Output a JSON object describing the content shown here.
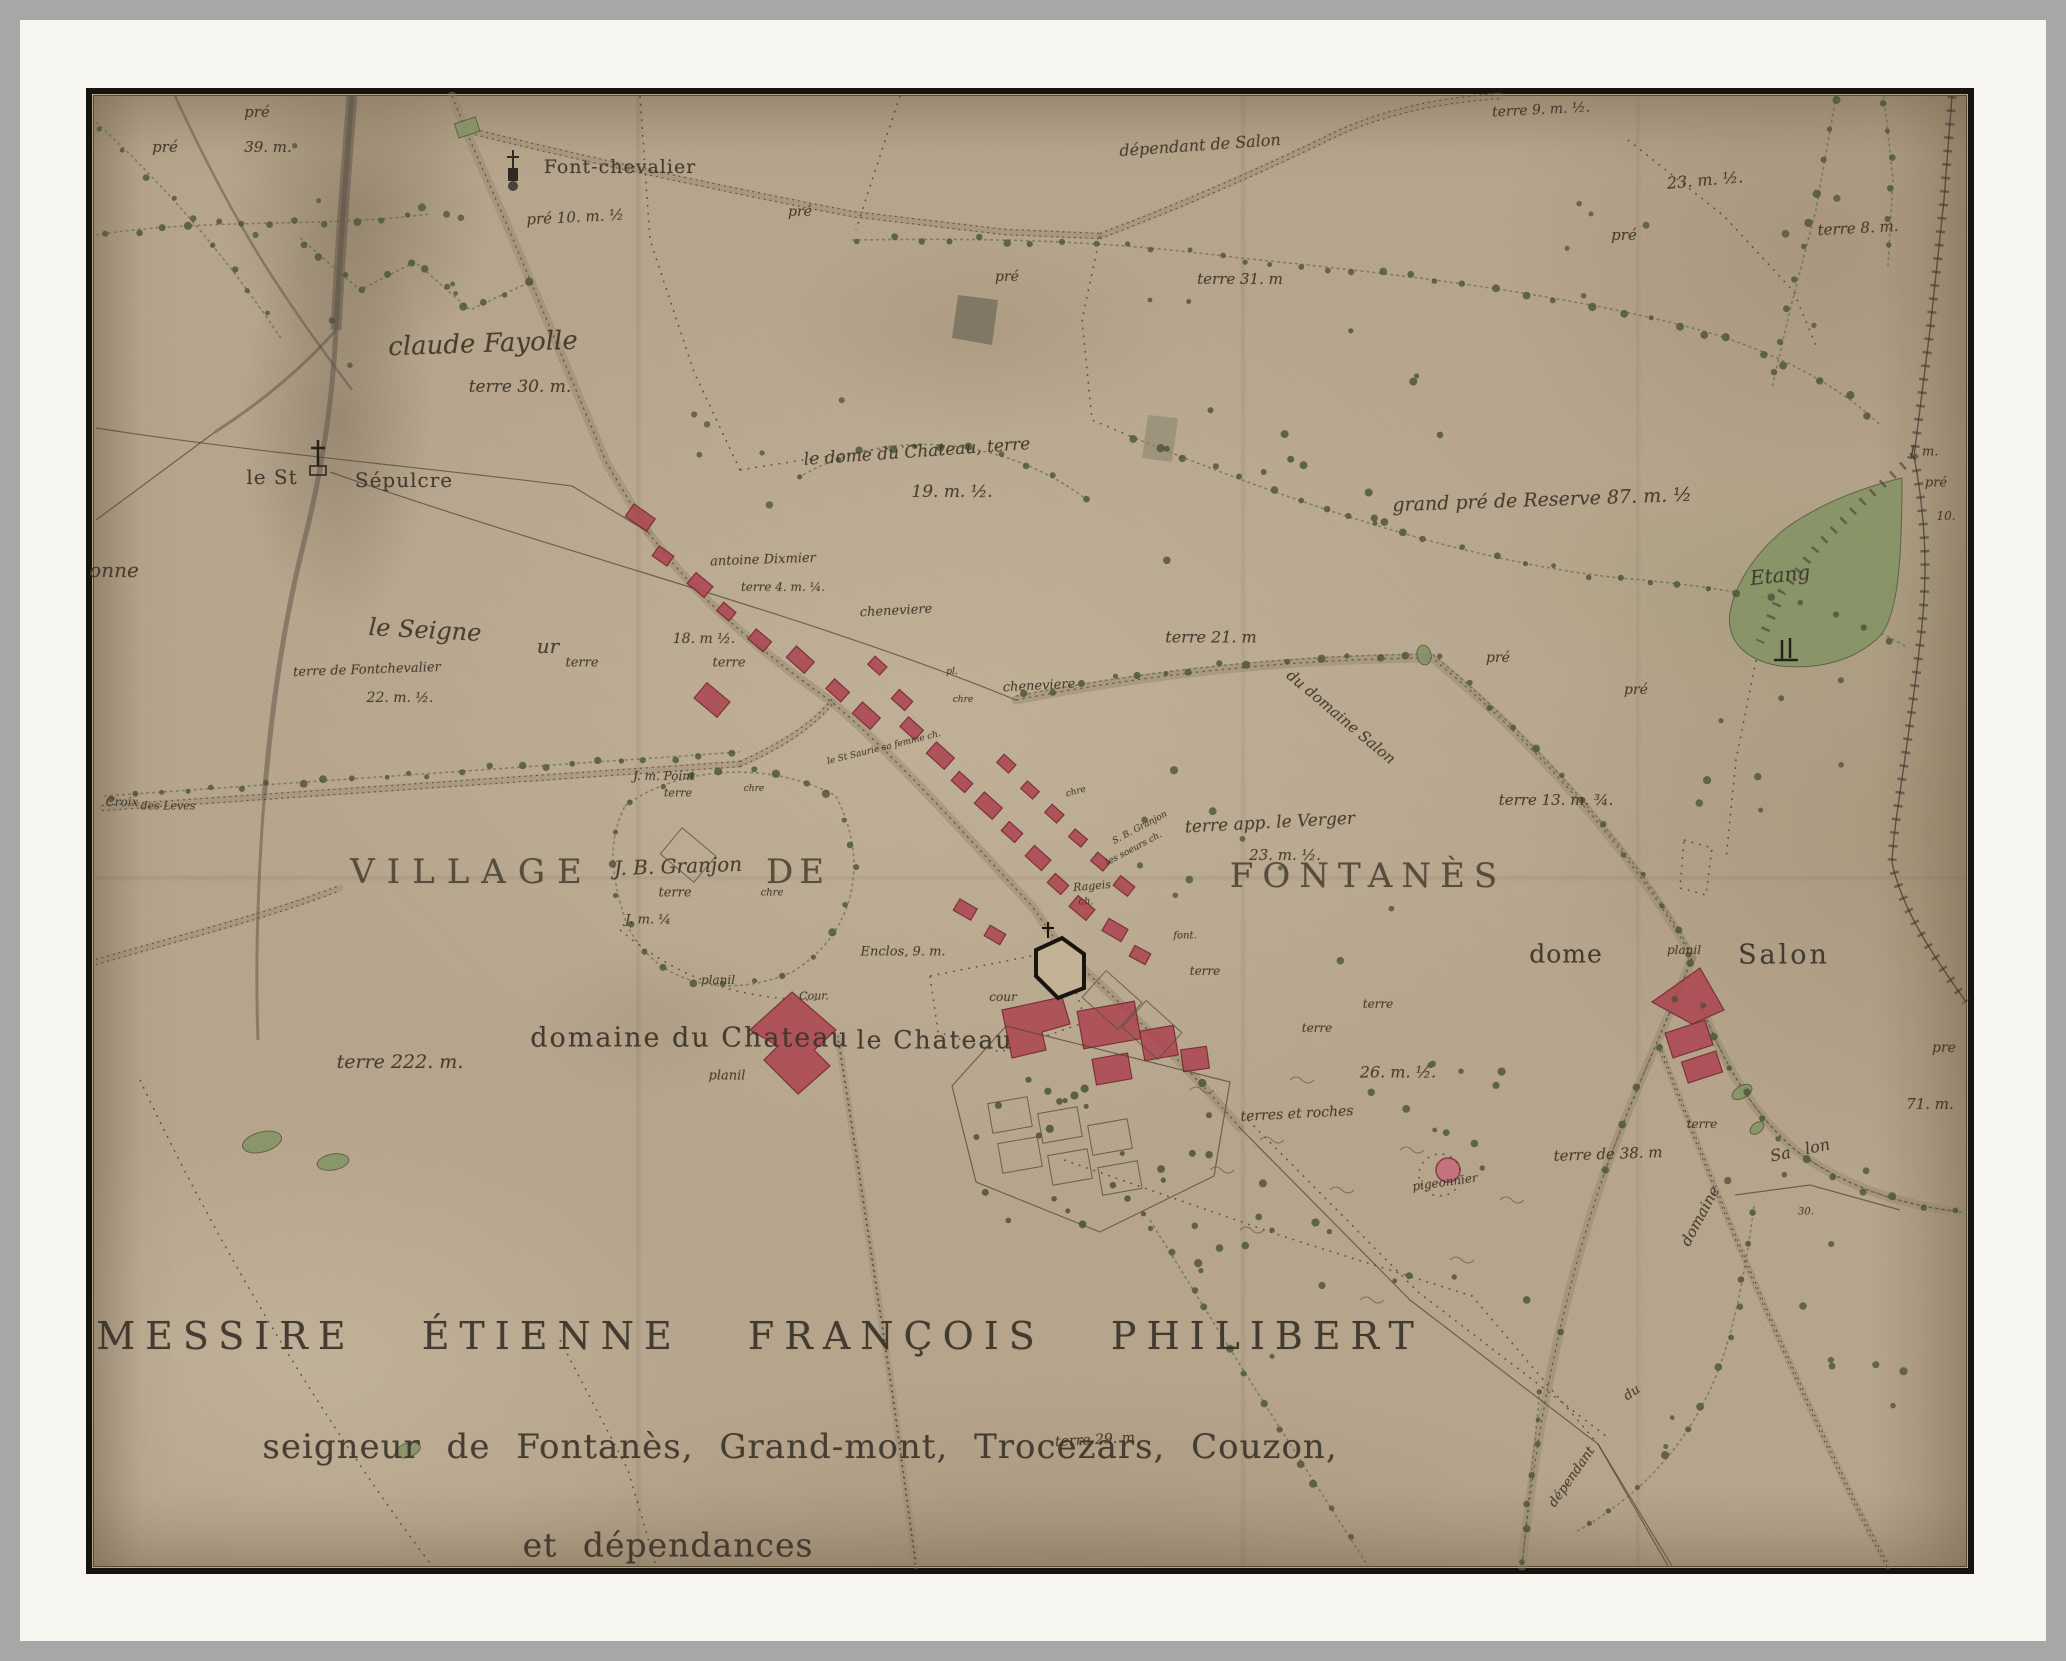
{
  "document_type": "historical estate map",
  "colors": {
    "outer_gray": "#a7a7a7",
    "mat_white": "#f7f5ef",
    "frame_black": "#16130e",
    "paper": "#b7a68d",
    "ink": "#3f372b",
    "building_red": "#ad4a55",
    "tree_green": "#4b5437",
    "water_green": "#839464"
  },
  "map": {
    "labels": [
      {
        "t": "pré",
        "x": 257,
        "y": 112,
        "s": 15
      },
      {
        "t": "pré",
        "x": 165,
        "y": 147,
        "s": 15
      },
      {
        "t": "39. m.",
        "x": 268,
        "y": 147,
        "s": 15
      },
      {
        "t": "Font-chevalier",
        "x": 620,
        "y": 167,
        "s": 19,
        "c": "rm"
      },
      {
        "t": "dépendant de Salon",
        "x": 1200,
        "y": 145,
        "s": 16,
        "r": -4
      },
      {
        "t": "terre 9. m. ½.",
        "x": 1541,
        "y": 110,
        "s": 14,
        "r": -3
      },
      {
        "t": "23. m. ½.",
        "x": 1705,
        "y": 180,
        "s": 16,
        "r": -5
      },
      {
        "t": "pré",
        "x": 1624,
        "y": 235,
        "s": 15
      },
      {
        "t": "terre 8. m.",
        "x": 1858,
        "y": 228,
        "s": 15,
        "r": -3
      },
      {
        "t": "pré 10. m. ½",
        "x": 575,
        "y": 217,
        "s": 15,
        "r": -3
      },
      {
        "t": "pré",
        "x": 800,
        "y": 212,
        "s": 14
      },
      {
        "t": "pré",
        "x": 1007,
        "y": 277,
        "s": 14
      },
      {
        "t": "terre 31. m",
        "x": 1240,
        "y": 279,
        "s": 15
      },
      {
        "t": "claude Fayolle",
        "x": 483,
        "y": 344,
        "s": 26,
        "r": -2
      },
      {
        "t": "terre 30. m.",
        "x": 520,
        "y": 387,
        "s": 17
      },
      {
        "t": "le St",
        "x": 272,
        "y": 477,
        "s": 20,
        "c": "rm"
      },
      {
        "t": "Sépulcre",
        "x": 404,
        "y": 480,
        "s": 20,
        "c": "rm"
      },
      {
        "t": "le dome du Chateau, terre",
        "x": 917,
        "y": 452,
        "s": 17,
        "r": -4
      },
      {
        "t": "19. m. ½.",
        "x": 952,
        "y": 492,
        "s": 17
      },
      {
        "t": "antoine Dixmier",
        "x": 763,
        "y": 560,
        "s": 13,
        "r": -2
      },
      {
        "t": "terre 4. m. ¼.",
        "x": 783,
        "y": 587,
        "s": 12
      },
      {
        "t": "cheneviere",
        "x": 896,
        "y": 611,
        "s": 13,
        "r": -3
      },
      {
        "t": "18. m ½.",
        "x": 704,
        "y": 639,
        "s": 14
      },
      {
        "t": "terre",
        "x": 729,
        "y": 663,
        "s": 13
      },
      {
        "t": "terre",
        "x": 582,
        "y": 663,
        "s": 13
      },
      {
        "t": "terre de Fontchevalier",
        "x": 367,
        "y": 670,
        "s": 13,
        "r": -2
      },
      {
        "t": "22. m. ½.",
        "x": 400,
        "y": 698,
        "s": 14
      },
      {
        "t": "le Seigne",
        "x": 425,
        "y": 630,
        "s": 24,
        "r": 3
      },
      {
        "t": "ur",
        "x": 548,
        "y": 646,
        "s": 20
      },
      {
        "t": "onne",
        "x": 114,
        "y": 570,
        "s": 20
      },
      {
        "t": "terre 21. m",
        "x": 1211,
        "y": 637,
        "s": 16
      },
      {
        "t": "grand pré de Reserve 87. m. ½",
        "x": 1542,
        "y": 500,
        "s": 19,
        "r": -2
      },
      {
        "t": "pré",
        "x": 1498,
        "y": 658,
        "s": 14
      },
      {
        "t": "pré",
        "x": 1636,
        "y": 690,
        "s": 14
      },
      {
        "t": "Etang",
        "x": 1780,
        "y": 575,
        "s": 20,
        "r": -6
      },
      {
        "t": "J. m.",
        "x": 1924,
        "y": 452,
        "s": 13
      },
      {
        "t": "pré",
        "x": 1936,
        "y": 483,
        "s": 13
      },
      {
        "t": "10.",
        "x": 1946,
        "y": 516,
        "s": 12
      },
      {
        "t": "du domaine Salon",
        "x": 1341,
        "y": 717,
        "s": 15,
        "r": 40
      },
      {
        "t": "terre 13. m. ¾.",
        "x": 1556,
        "y": 800,
        "s": 15
      },
      {
        "t": "cheneviere",
        "x": 1039,
        "y": 686,
        "s": 13,
        "r": -3
      },
      {
        "t": "pl.",
        "x": 952,
        "y": 672,
        "s": 9
      },
      {
        "t": "chre",
        "x": 963,
        "y": 700,
        "s": 9
      },
      {
        "t": "chre",
        "x": 1076,
        "y": 792,
        "s": 9,
        "r": -15
      },
      {
        "t": "J. m. Point",
        "x": 664,
        "y": 776,
        "s": 12
      },
      {
        "t": "terre",
        "x": 678,
        "y": 793,
        "s": 11
      },
      {
        "t": "chre",
        "x": 754,
        "y": 789,
        "s": 9
      },
      {
        "t": "le St Saurie sa femme ch.",
        "x": 884,
        "y": 748,
        "s": 9,
        "r": -14
      },
      {
        "t": "VILLAGE",
        "x": 472,
        "y": 872,
        "s": 34,
        "c": "caps",
        "ls": 12
      },
      {
        "t": "DE",
        "x": 798,
        "y": 872,
        "s": 34,
        "c": "caps",
        "ls": 6
      },
      {
        "t": "FONTANÈS",
        "x": 1368,
        "y": 876,
        "s": 34,
        "c": "caps",
        "ls": 9
      },
      {
        "t": "J. B. Granjon",
        "x": 678,
        "y": 866,
        "s": 20,
        "r": -2
      },
      {
        "t": "terre",
        "x": 675,
        "y": 893,
        "s": 13
      },
      {
        "t": "J. m. ¼",
        "x": 648,
        "y": 920,
        "s": 13
      },
      {
        "t": "chre",
        "x": 772,
        "y": 893,
        "s": 10
      },
      {
        "t": "terre app. le Verger",
        "x": 1270,
        "y": 823,
        "s": 17,
        "r": -3
      },
      {
        "t": "23. m. ½.",
        "x": 1285,
        "y": 855,
        "s": 15
      },
      {
        "t": "S. B. Granjon",
        "x": 1140,
        "y": 828,
        "s": 9,
        "r": -28
      },
      {
        "t": "les soeurs ch.",
        "x": 1134,
        "y": 849,
        "s": 9,
        "r": -28
      },
      {
        "t": "Rageis",
        "x": 1092,
        "y": 886,
        "s": 11,
        "r": -5
      },
      {
        "t": "ch.",
        "x": 1086,
        "y": 902,
        "s": 10
      },
      {
        "t": "font.",
        "x": 1185,
        "y": 936,
        "s": 10
      },
      {
        "t": "terre",
        "x": 1205,
        "y": 971,
        "s": 12
      },
      {
        "t": "terre",
        "x": 1378,
        "y": 1004,
        "s": 12
      },
      {
        "t": "terre",
        "x": 1317,
        "y": 1028,
        "s": 12
      },
      {
        "t": "planil",
        "x": 718,
        "y": 980,
        "s": 12
      },
      {
        "t": "Cour.",
        "x": 814,
        "y": 996,
        "s": 11
      },
      {
        "t": "cour",
        "x": 1003,
        "y": 997,
        "s": 12
      },
      {
        "t": "Enclos, 9. m.",
        "x": 903,
        "y": 952,
        "s": 13
      },
      {
        "t": "domaine du Chateau",
        "x": 690,
        "y": 1038,
        "s": 27,
        "c": "rm",
        "ls": 2
      },
      {
        "t": "planil",
        "x": 727,
        "y": 1076,
        "s": 13
      },
      {
        "t": "le Chateau",
        "x": 935,
        "y": 1040,
        "s": 25,
        "c": "rm",
        "ls": 2
      },
      {
        "t": "terre 222. m.",
        "x": 400,
        "y": 1062,
        "s": 19
      },
      {
        "t": "dome",
        "x": 1566,
        "y": 954,
        "s": 25,
        "c": "rm"
      },
      {
        "t": "planil",
        "x": 1684,
        "y": 950,
        "s": 12
      },
      {
        "t": "Salon",
        "x": 1784,
        "y": 955,
        "s": 27,
        "c": "rm",
        "ls": 3
      },
      {
        "t": "pre",
        "x": 1944,
        "y": 1048,
        "s": 14
      },
      {
        "t": "71. m.",
        "x": 1930,
        "y": 1104,
        "s": 15
      },
      {
        "t": "terre",
        "x": 1702,
        "y": 1124,
        "s": 12
      },
      {
        "t": "26. m. ½.",
        "x": 1398,
        "y": 1072,
        "s": 16
      },
      {
        "t": "terres et roches",
        "x": 1297,
        "y": 1114,
        "s": 14,
        "r": -3
      },
      {
        "t": "pigeonnier",
        "x": 1445,
        "y": 1182,
        "s": 12,
        "r": -8
      },
      {
        "t": "terre de 38. m",
        "x": 1608,
        "y": 1154,
        "s": 15,
        "r": -2
      },
      {
        "t": "Sa lon",
        "x": 1800,
        "y": 1150,
        "s": 16,
        "r": -12,
        "ws": 10
      },
      {
        "t": "domaine",
        "x": 1700,
        "y": 1216,
        "s": 15,
        "r": -62
      },
      {
        "t": "30.",
        "x": 1806,
        "y": 1212,
        "s": 10
      },
      {
        "t": "dépendant",
        "x": 1572,
        "y": 1477,
        "s": 13,
        "r": -55
      },
      {
        "t": "du",
        "x": 1632,
        "y": 1393,
        "s": 13,
        "r": -35
      },
      {
        "t": "terre 29. m",
        "x": 1095,
        "y": 1440,
        "s": 14,
        "r": -3
      },
      {
        "t": "Croix",
        "x": 122,
        "y": 802,
        "s": 12
      },
      {
        "t": "des Leves",
        "x": 168,
        "y": 806,
        "s": 11
      },
      {
        "t": "MESSIRE ÉTIENNE FRANÇOIS PHILIBERT",
        "x": 760,
        "y": 1336,
        "s": 38,
        "c": "title1"
      },
      {
        "t": "seigneur de Fontanès, Grand-mont, Trocezars, Couzon,",
        "x": 800,
        "y": 1447,
        "s": 34,
        "c": "title2"
      },
      {
        "t": "et dépendances",
        "x": 668,
        "y": 1545,
        "s": 33,
        "c": "title2"
      }
    ]
  }
}
